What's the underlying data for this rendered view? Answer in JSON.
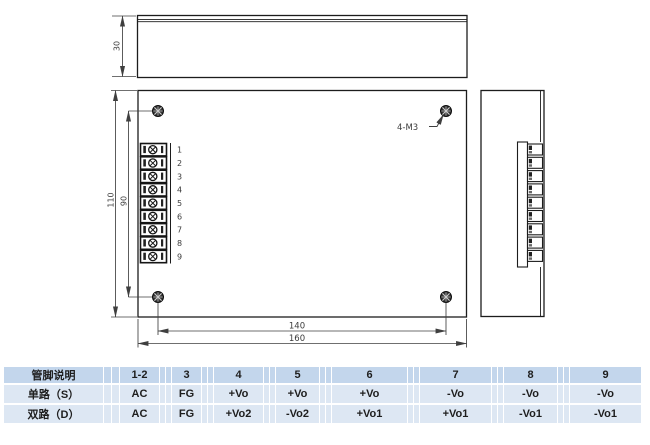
{
  "drawing": {
    "dimensions": {
      "side_height": "30",
      "front_height": "110",
      "mount_hole_spacing_v": "90",
      "mount_hole_spacing_h": "140",
      "front_width": "160"
    },
    "mount_hole_label": "4-M3",
    "terminal_numbers": [
      "1",
      "2",
      "3",
      "4",
      "5",
      "6",
      "7",
      "8",
      "9"
    ]
  },
  "pin_table": {
    "header": [
      "管脚说明",
      "1-2",
      "3",
      "4",
      "5",
      "6",
      "7",
      "8",
      "9"
    ],
    "rows": [
      {
        "label": "单路（S）",
        "values": [
          "AC",
          "FG",
          "+Vo",
          "+Vo",
          "+Vo",
          "-Vo",
          "-Vo",
          "-Vo"
        ]
      },
      {
        "label": "双路（D）",
        "values": [
          "AC",
          "FG",
          "+Vo2",
          "-Vo2",
          "+Vo1",
          "+Vo1",
          "-Vo1",
          "-Vo1"
        ]
      }
    ],
    "colors": {
      "header_bg": "#c3d6ec",
      "row_bg": "#dde7f3",
      "grid_line": "#ffffff"
    }
  }
}
